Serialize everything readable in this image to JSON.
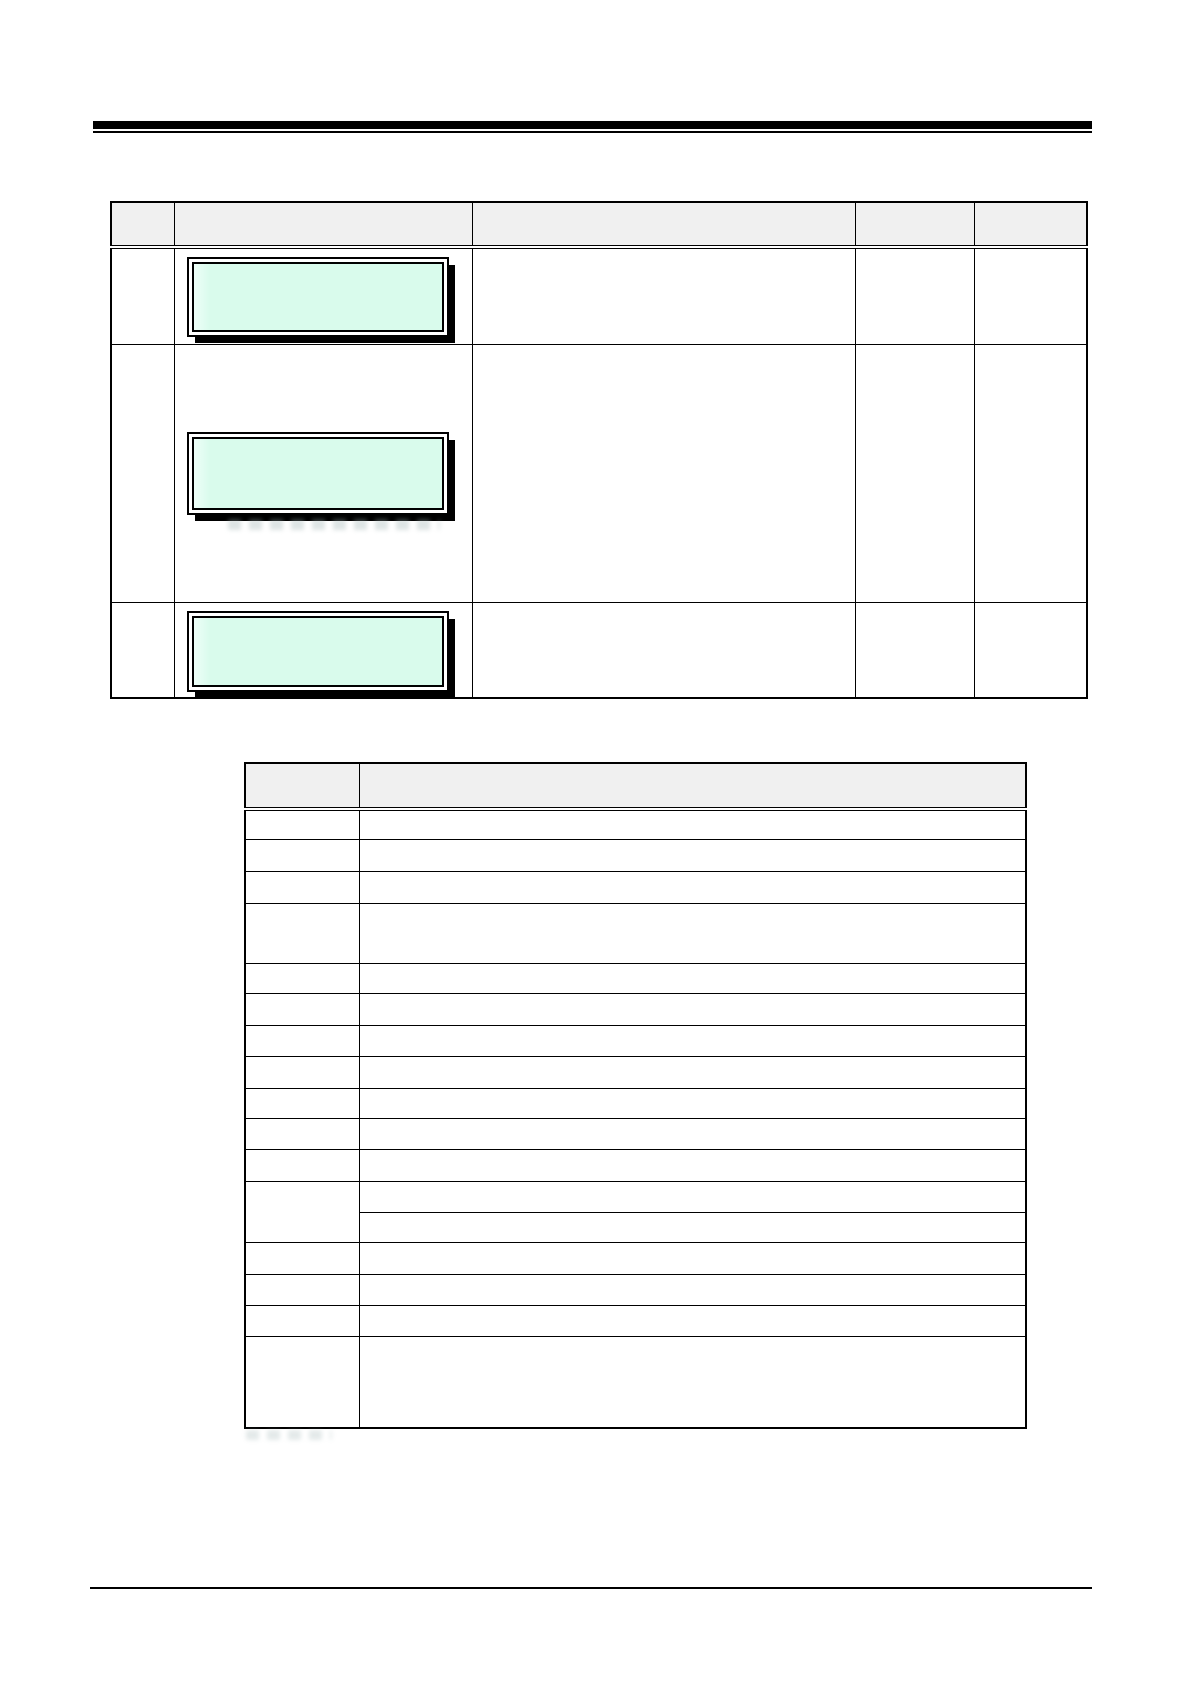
{
  "page": {
    "width_px": 1191,
    "height_px": 1684,
    "background": "#ffffff"
  },
  "colors": {
    "rule": "#000000",
    "table_border": "#000000",
    "table_header_fill": "#f0f0f0",
    "lcd_fill": "#d9fbec",
    "lcd_highlight": "#eefff8",
    "lcd_frame": "#000000",
    "ghost_text": "#9fb4b4"
  },
  "table1": {
    "column_widths_px": [
      63,
      298,
      382,
      119,
      112
    ],
    "header_height_px": 45,
    "header_cells": [
      "",
      "",
      "",
      "",
      ""
    ],
    "rows": [
      {
        "height_px": 97,
        "cells": [
          "",
          "",
          "",
          "",
          ""
        ],
        "display": {
          "text": "",
          "top_px": 8,
          "height_px": 80
        },
        "ghost_caption": false
      },
      {
        "height_px": 258,
        "cells": [
          "",
          "",
          "",
          "",
          ""
        ],
        "display": {
          "text": "",
          "top_px": 87,
          "height_px": 83
        },
        "ghost_caption": true
      },
      {
        "height_px": 96,
        "cells": [
          "",
          "",
          "",
          "",
          ""
        ],
        "display": {
          "text": "",
          "top_px": 8,
          "height_px": 81
        },
        "ghost_caption": false
      }
    ]
  },
  "table2": {
    "column_widths_px": [
      114,
      665
    ],
    "header_height_px": 46,
    "header_cells": [
      "",
      ""
    ],
    "rows": [
      {
        "height_px": 30,
        "cells": [
          "",
          ""
        ]
      },
      {
        "height_px": 32,
        "cells": [
          "",
          ""
        ]
      },
      {
        "height_px": 32,
        "cells": [
          "",
          ""
        ]
      },
      {
        "height_px": 60,
        "cells": [
          "",
          ""
        ]
      },
      {
        "height_px": 30,
        "cells": [
          "",
          ""
        ]
      },
      {
        "height_px": 32,
        "cells": [
          "",
          ""
        ]
      },
      {
        "height_px": 31,
        "cells": [
          "",
          ""
        ]
      },
      {
        "height_px": 32,
        "cells": [
          "",
          ""
        ]
      },
      {
        "height_px": 30,
        "cells": [
          "",
          ""
        ]
      },
      {
        "height_px": 31,
        "cells": [
          "",
          ""
        ]
      },
      {
        "height_px": 32,
        "cells": [
          "",
          ""
        ]
      },
      {
        "split": true,
        "col1": "",
        "sub_rows": [
          {
            "height_px": 31,
            "cell": ""
          },
          {
            "height_px": 30,
            "cell": ""
          }
        ]
      },
      {
        "height_px": 32,
        "cells": [
          "",
          ""
        ]
      },
      {
        "height_px": 31,
        "cells": [
          "",
          ""
        ]
      },
      {
        "height_px": 31,
        "cells": [
          "",
          ""
        ]
      },
      {
        "height_px": 92,
        "cells": [
          "",
          ""
        ]
      }
    ]
  }
}
